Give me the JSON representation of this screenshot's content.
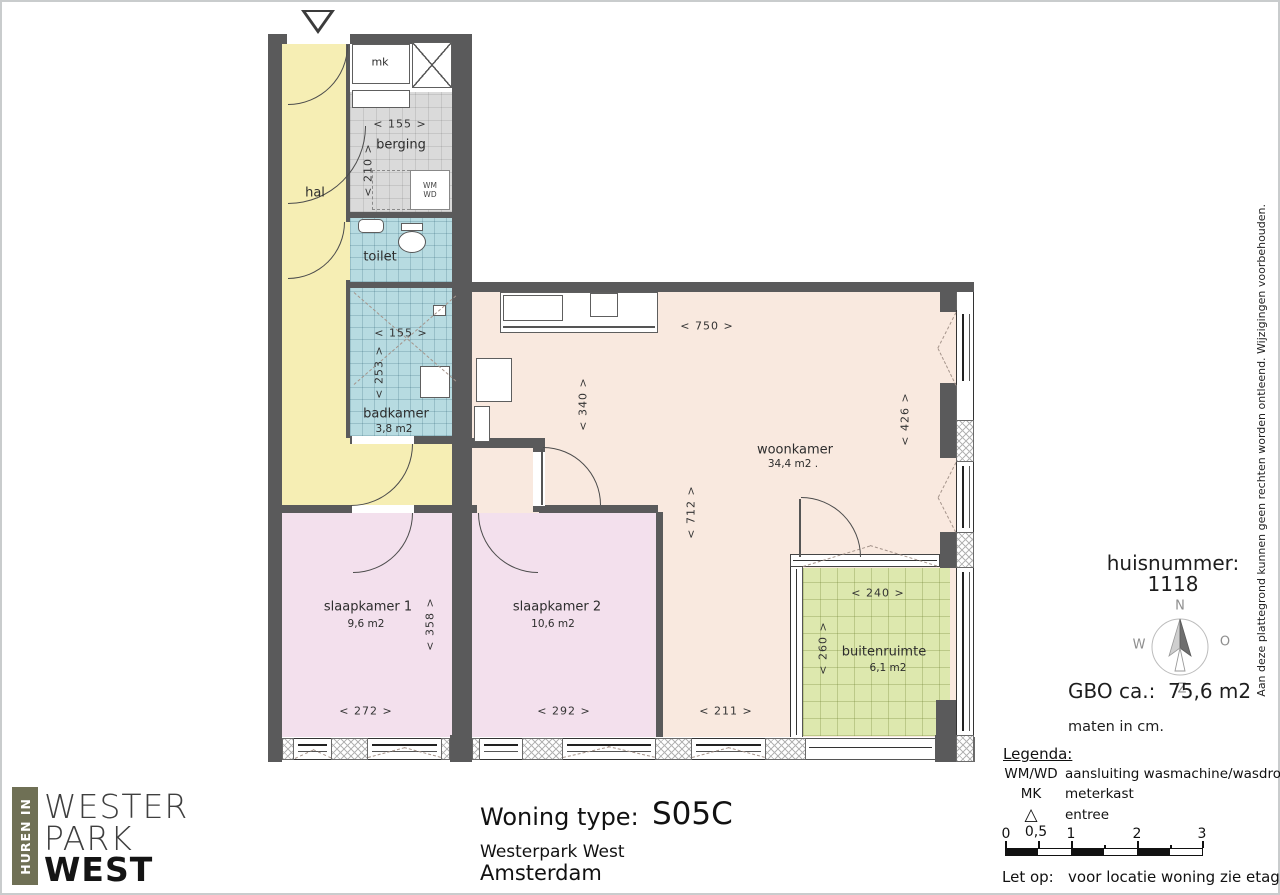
{
  "plan": {
    "rooms": {
      "hal": {
        "label": "hal"
      },
      "mk": {
        "label": "mk"
      },
      "berging": {
        "label": "berging"
      },
      "toilet": {
        "label": "toilet"
      },
      "badkamer": {
        "label": "badkamer",
        "area": "3,8 m2"
      },
      "woonkamer": {
        "label": "woonkamer",
        "area": "34,4 m2 ."
      },
      "slaapkamer1": {
        "label": "slaapkamer 1",
        "area": "9,6 m2"
      },
      "slaapkamer2": {
        "label": "slaapkamer 2",
        "area": "10,6 m2"
      },
      "buitenruimte": {
        "label": "buitenruimte",
        "area": "6,1 m2"
      }
    },
    "dims": {
      "berging_w": "<  155  >",
      "berging_h": "<  210  >",
      "badkamer_w": "<  155  >",
      "badkamer_h": "<  253  >",
      "woon_w": "<  750  >",
      "woon_h_left": "<  340  >",
      "woon_h_mid": "<  712  >",
      "woon_h_right": "<  426  >",
      "sl1_w": "<  272  >",
      "sl1_h": "<  358  >",
      "sl2_w": "<  292  >",
      "woon_bottom_w": "<  211  >",
      "buiten_w": "<  240  >",
      "buiten_h": "<  260  >"
    },
    "appliances": {
      "wm": "WM",
      "wd": "WD"
    }
  },
  "info": {
    "huisnummer_label": "huisnummer:",
    "huisnummer_value": "1118",
    "compass": {
      "n": "N",
      "e": "O",
      "s": "Z",
      "w": "W"
    },
    "gbo_label": "GBO ca.:",
    "gbo_value": "75,6 m2",
    "maten": "maten in cm.",
    "legenda_title": "Legenda:",
    "legend": [
      {
        "key": "WM/WD",
        "desc": "aansluiting wasmachine/wasdroger"
      },
      {
        "key": "MK",
        "desc": "meterkast"
      },
      {
        "key": "△",
        "desc": "entree"
      }
    ],
    "scale_labels": [
      "0",
      "0,5",
      "1",
      "2",
      "3"
    ],
    "note_label": "Let op:",
    "note_text": "voor locatie woning zie etageoverzicht."
  },
  "footer": {
    "brand_vertical": "HUREN IN",
    "brand_line1": "WESTER",
    "brand_line2": "PARK",
    "brand_line3": "WEST",
    "type_label": "Woning type:",
    "type_value": "S05C",
    "project": "Westerpark West",
    "city": "Amsterdam"
  },
  "disclaimer": "Aan deze plattegrond kunnen geen rechten worden ontleend. Wijzigingen voorbehouden."
}
